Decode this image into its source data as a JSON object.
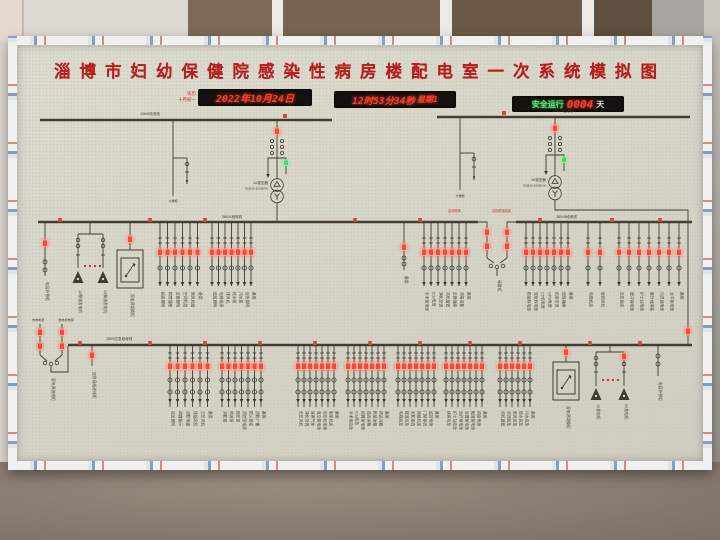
{
  "title": "淄博市妇幼保健院感染性病房楼配电室一次系统模拟图",
  "displays": {
    "note_line1": "农历",
    "note_line2": "十月初一",
    "date": "2022年10月24日",
    "time": "12时53分34秒",
    "weekday": "星期1",
    "safety_prefix": "安全运行",
    "safety_days": "0004",
    "safety_suffix": "天"
  },
  "colors": {
    "title_red": "#b6201d",
    "led_red": "#ff4636",
    "led_green": "#46d964",
    "board_face": "#d6d5c7",
    "bus_line": "#453c33",
    "display_bg": "#16110e"
  },
  "top_left": {
    "bus_label": "10kVⅠ段进线",
    "meter_label": "计量柜",
    "transformer_name": "1#变压器",
    "transformer_spec": "SCB13-1000kVA"
  },
  "top_right": {
    "bus_label": "10kVⅡ段进线",
    "meter_label": "计量柜",
    "transformer_name": "2#变压器",
    "transformer_spec": "SCB13-1000kVA"
  },
  "bus_a": {
    "left_label": "380VⅠ段母线",
    "right_label": "380VⅡ段母线",
    "tie_label": "母联柜",
    "tie_note_left": "自动转换",
    "tie_note_right": "自投联锁装置"
  },
  "bus_b": {
    "label": "380V应急段母线",
    "left_in_label1": "市电电源",
    "left_in_label2": "发电机电源",
    "left_in_cabinet": "双电源进线柜",
    "incoming_label": "应急母线进线柜"
  },
  "devices": {
    "cap_left": "电容补偿柜",
    "cap_right": "电容补偿柜",
    "ats_a": "双电源切换柜",
    "ats_b": "双电源切换柜",
    "gen_a1": "1#柴油发电机",
    "gen_a2": "2#柴油发电机",
    "gen_b1": "1#发电机",
    "gen_b2": "2#发电机",
    "spare": "备用"
  },
  "feeder_groups": [
    {
      "bus": "A",
      "x": 160,
      "spacing": 7.5,
      "labels": [
        "病房照明",
        "病房插座",
        "走廊照明",
        "空调机组",
        "新风机组",
        "备用"
      ]
    },
    {
      "bus": "A",
      "x": 212,
      "spacing": 6.5,
      "labels": [
        "值班照明",
        "电梯电源",
        "排风机",
        "给水泵",
        "污水泵",
        "应急照明",
        "备用"
      ]
    },
    {
      "bus": "A",
      "x": 424,
      "spacing": 7,
      "labels": [
        "手术室电源",
        "ICU电源",
        "净化空调",
        "风机盘管",
        "走廊插座",
        "消毒设备",
        "备用"
      ]
    },
    {
      "bus": "A",
      "x": 526,
      "spacing": 7,
      "labels": [
        "检验科电源",
        "放射科电源",
        "CT机电源",
        "UPS电源",
        "机房空调",
        "值班插座",
        "备用"
      ]
    },
    {
      "bus": "A",
      "x": 588,
      "spacing": 12,
      "labels": [
        "电梯机房",
        "屋顶风机"
      ]
    },
    {
      "bus": "A",
      "x": 619,
      "spacing": 10,
      "labels": [
        "负压病房",
        "缓冲间电源",
        "护士站电源",
        "紫外线消毒",
        "污洗间电源",
        "太平柜电源",
        "备用"
      ]
    },
    {
      "bus": "B",
      "x": 170,
      "spacing": 7.5,
      "labels": [
        "应急照明",
        "疏散指示",
        "消防电梯",
        "排烟风机",
        "正压风机",
        "备用"
      ]
    },
    {
      "bus": "B",
      "x": 222,
      "spacing": 6.5,
      "labels": [
        "消防泵",
        "喷淋泵",
        "稳压泵",
        "消控室电源",
        "防火卷帘",
        "消防广播",
        "备用"
      ]
    },
    {
      "bus": "B",
      "x": 298,
      "spacing": 6,
      "labels": [
        "负压风机",
        "净化空调",
        "医用气体",
        "真空泵电源",
        "空压机电源",
        "制氧机房",
        "备用"
      ]
    },
    {
      "bus": "B",
      "x": 348,
      "spacing": 6,
      "labels": [
        "手术室应急",
        "ICU应急",
        "抢救室电源",
        "血库冰箱",
        "检验冰箱",
        "药品冷藏",
        "备用"
      ]
    },
    {
      "bus": "B",
      "x": 398,
      "spacing": 6,
      "labels": [
        "电梯应急",
        "楼道应急",
        "安防系统",
        "网络机房",
        "门禁系统",
        "监控电源",
        "备用"
      ]
    },
    {
      "bus": "B",
      "x": 446,
      "spacing": 6,
      "labels": [
        "病房应急",
        "护士站应急",
        "治疗室电源",
        "处置室电源",
        "配液室电源",
        "药房电源",
        "备用"
      ]
    },
    {
      "bus": "B",
      "x": 500,
      "spacing": 6,
      "labels": [
        "风机盘管",
        "空调应急",
        "新风应急",
        "给水应急",
        "污水应急",
        "备用"
      ]
    }
  ],
  "bus_markers": {
    "a": [
      60,
      150,
      205,
      355,
      420,
      540,
      612,
      660
    ],
    "b": [
      80,
      150,
      205,
      260,
      315,
      370,
      420,
      470,
      520,
      590,
      640
    ]
  }
}
